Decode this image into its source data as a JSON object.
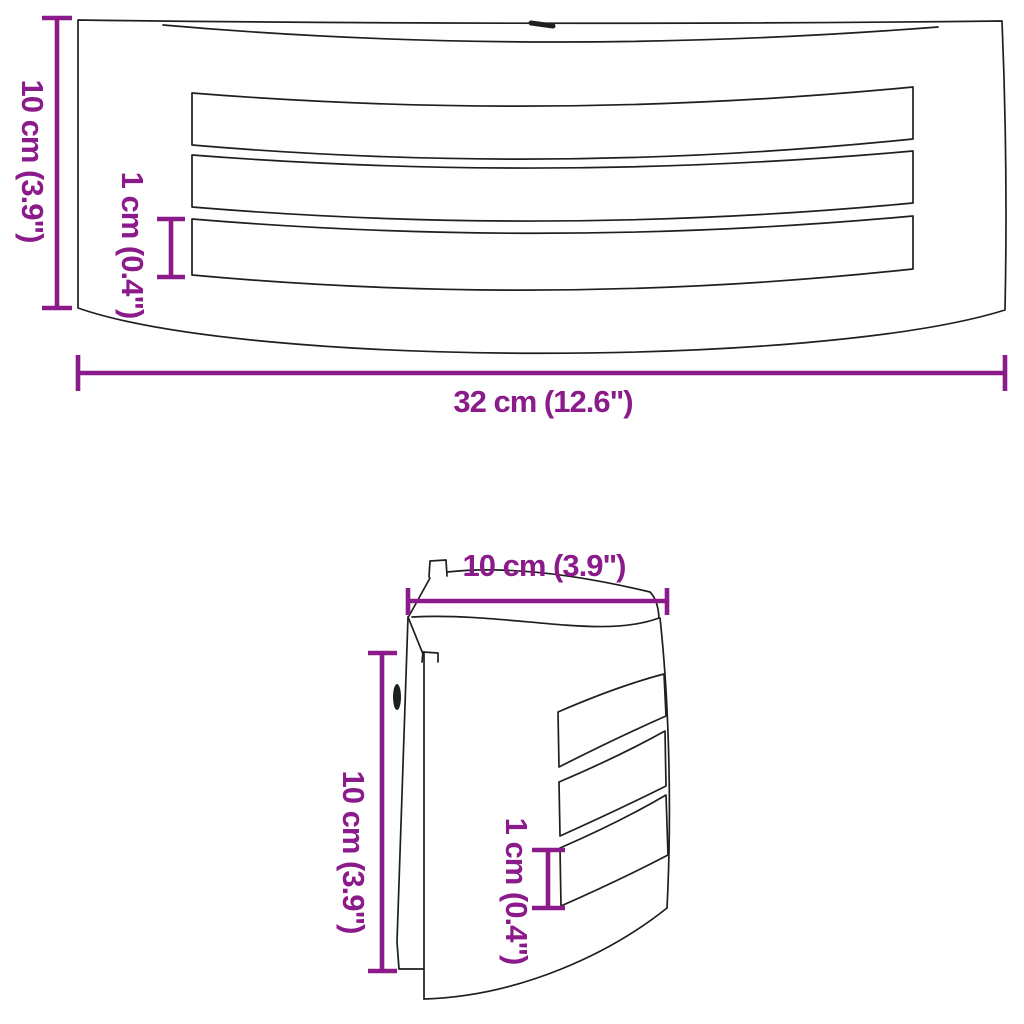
{
  "colors": {
    "dimension_accent": "#8B1A8B",
    "line_art": "#1F1F1F",
    "background": "#FFFFFF"
  },
  "front_view": {
    "height_label": "10 cm (3.9\")",
    "slot_height_label": "1 cm (0.4\")",
    "width_label": "32 cm (12.6\")"
  },
  "side_view": {
    "depth_label": "10 cm (3.9\")",
    "height_label": "10 cm (3.9\")",
    "slot_height_label": "1 cm (0.4\")"
  }
}
